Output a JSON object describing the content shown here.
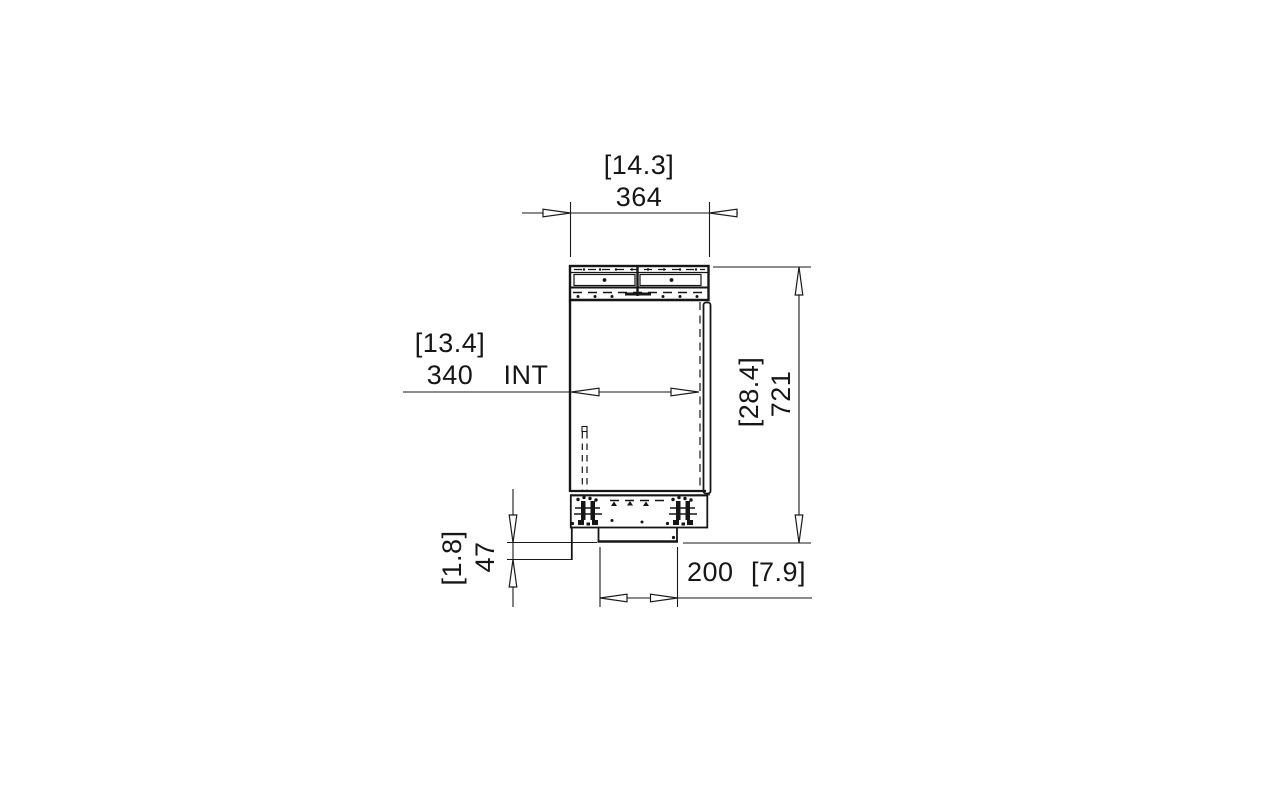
{
  "drawing": {
    "kind": "technical-dimension-drawing",
    "line_color": "#161616",
    "background": "#ffffff",
    "dimensions": {
      "top_width": {
        "inches_label": "[14.3]",
        "mm_label": "364"
      },
      "internal_width": {
        "inches_label": "[13.4]",
        "mm_label": "340",
        "suffix_label": "INT"
      },
      "overall_height": {
        "inches_label": "[28.4]",
        "mm_label": "721"
      },
      "base_height": {
        "inches_label": "[1.8]",
        "mm_label": "47"
      },
      "base_width": {
        "mm_label": "200",
        "inches_label": "[7.9]"
      }
    }
  }
}
